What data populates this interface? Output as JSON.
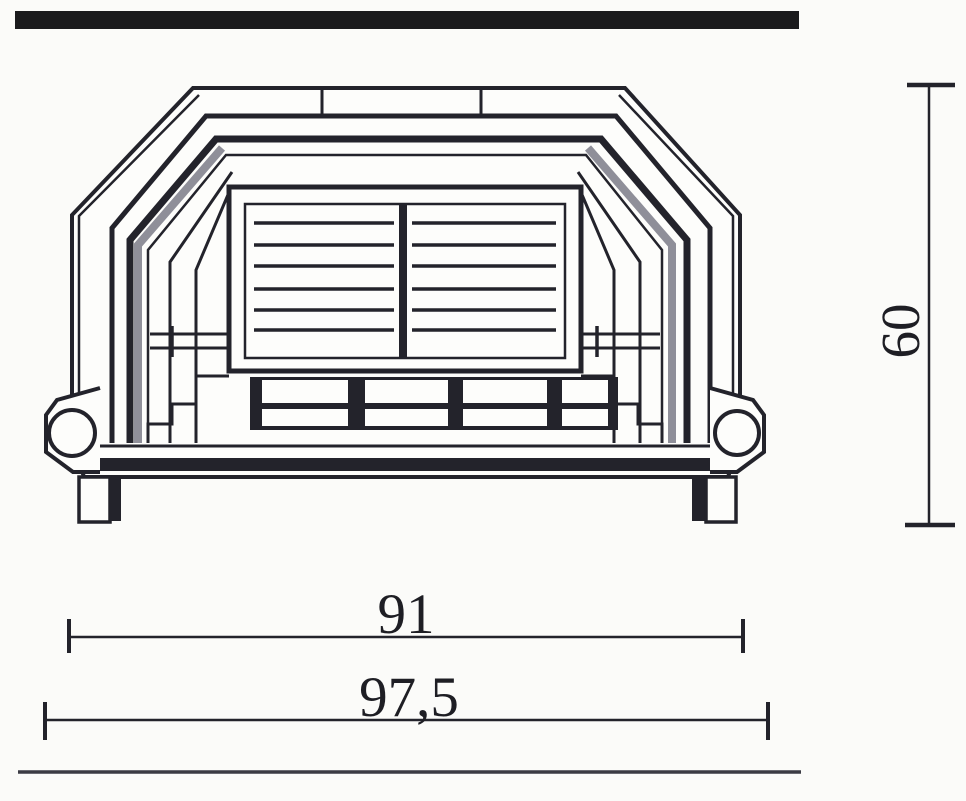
{
  "palette": {
    "line": "#23232b",
    "shade": "#8f8f99",
    "bar": "#1b1b1d",
    "background": "#fbfbf9",
    "floor": "#3b3b44",
    "paper": "#fdfdfb"
  },
  "drawing": {
    "subject": "fireplace-stove-front-elevation"
  },
  "dimensions": {
    "inner_width": "91",
    "outer_width": "97,5",
    "height": "60"
  }
}
